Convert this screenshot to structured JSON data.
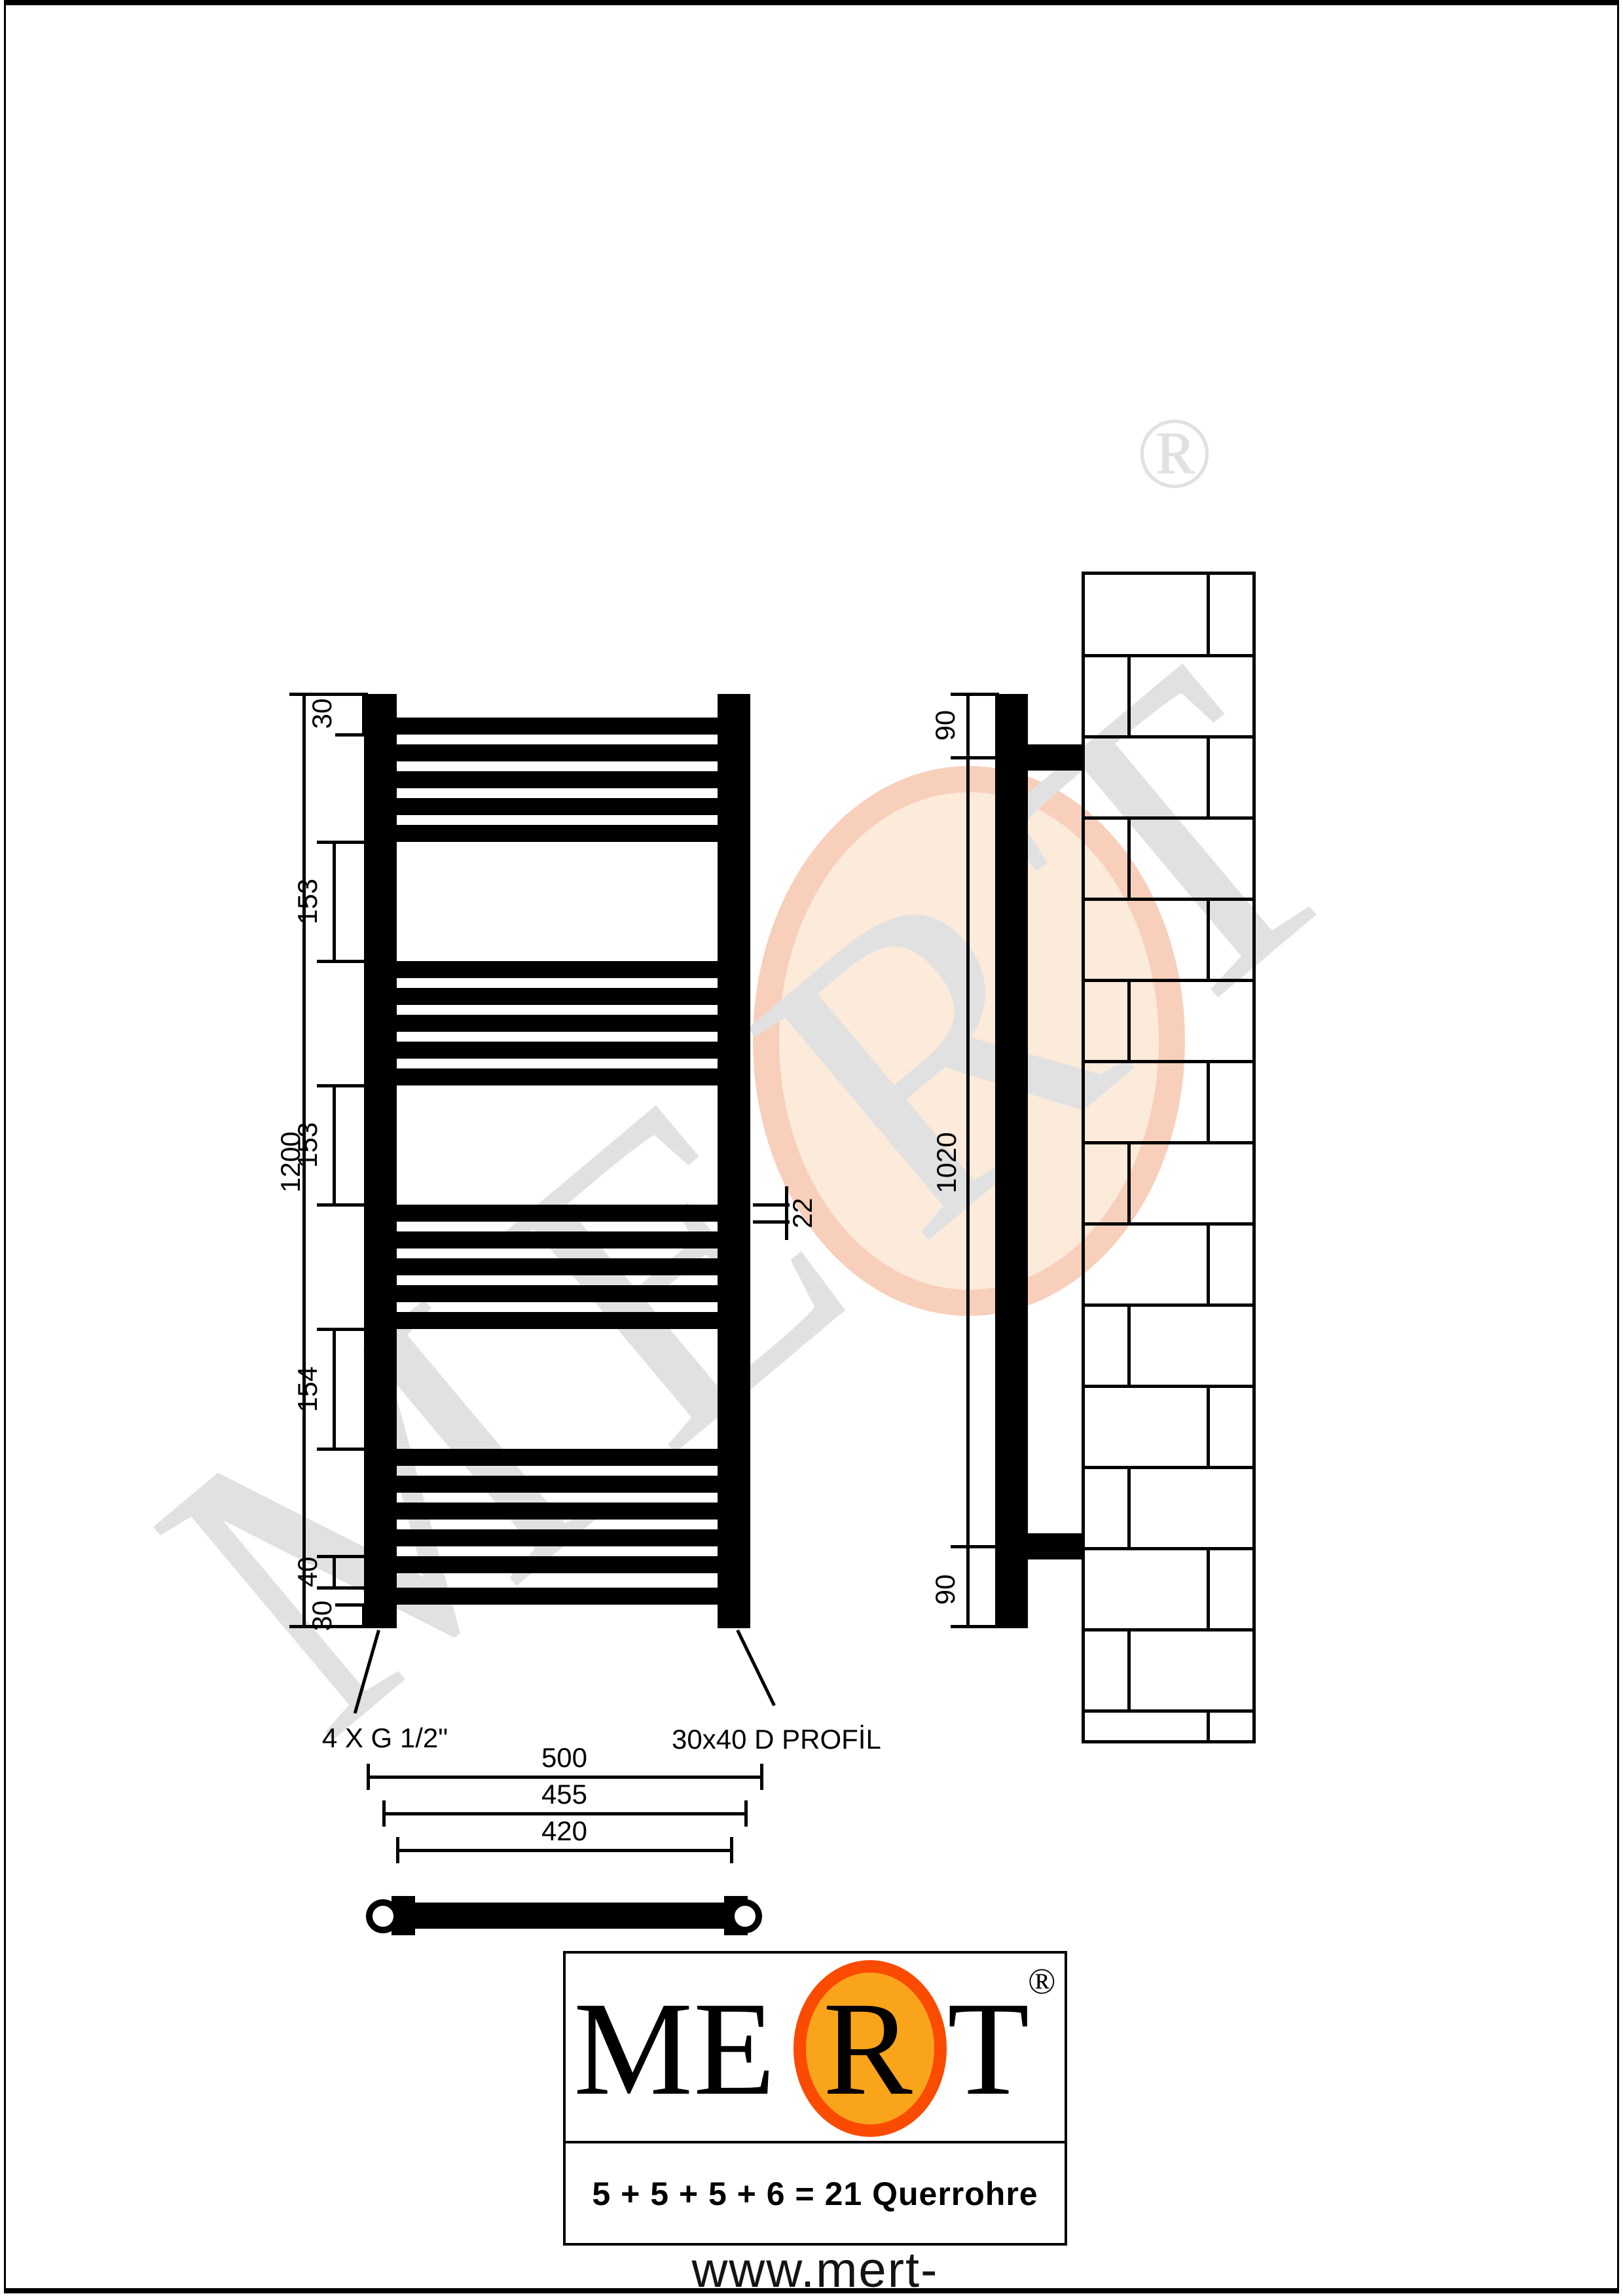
{
  "drawing_title": "MERT towel radiator technical drawing",
  "radiator": {
    "groups": [
      5,
      5,
      5,
      6
    ],
    "total_cross_tubes": 21
  },
  "dimensions": {
    "overall_height": "1200",
    "top_offset": "30",
    "group_gaps": [
      "153",
      "153",
      "154"
    ],
    "bottom_pitch": "40",
    "bottom_offset": "30",
    "tube_thickness": "22",
    "widths": [
      "500",
      "455",
      "420"
    ],
    "bracket_top": "90",
    "bracket_span": "1020",
    "bracket_bottom": "90"
  },
  "labels": {
    "connections": "4 X G 1/2\"",
    "profile": "30x40 D PROFİL"
  },
  "logo": {
    "name_letters": [
      "M",
      "E",
      "R",
      "T"
    ],
    "registered": "®",
    "formula": "5 + 5 + 5 + 6 = 21 Querrohre",
    "website": "www.mert-radiator.com"
  },
  "watermark": {
    "text": "MERT",
    "registered": "®"
  },
  "colors": {
    "drawing": "#000000",
    "watermark_gray": "#e1e1e1",
    "watermark_peach_fill": "#fceadb",
    "watermark_peach_ring": "#f8cfbb",
    "logo_orange_fill": "#faa41b",
    "logo_orange_ring": "#fa4b00"
  }
}
